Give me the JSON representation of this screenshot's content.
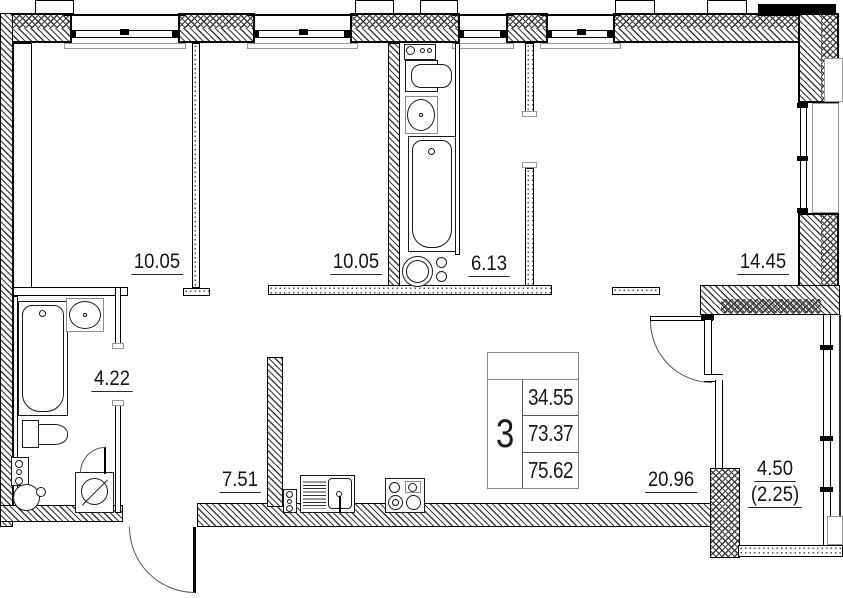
{
  "plan": {
    "background": "#ffffff",
    "line_color": "#000000",
    "room_labels": [
      {
        "name": "room-1",
        "area": "10.05"
      },
      {
        "name": "room-2",
        "area": "10.05"
      },
      {
        "name": "corridor",
        "area": "6.13"
      },
      {
        "name": "room-3",
        "area": "14.45"
      },
      {
        "name": "bathroom",
        "area": "4.22"
      },
      {
        "name": "hall",
        "area": "7.51"
      },
      {
        "name": "living-room",
        "area": "20.96"
      },
      {
        "name": "balcony",
        "area": "4.50",
        "area_coef": "(2.25)"
      }
    ],
    "info_table": {
      "rooms_count": "3",
      "rows": [
        "34.55",
        "73.37",
        "75.62"
      ]
    }
  }
}
